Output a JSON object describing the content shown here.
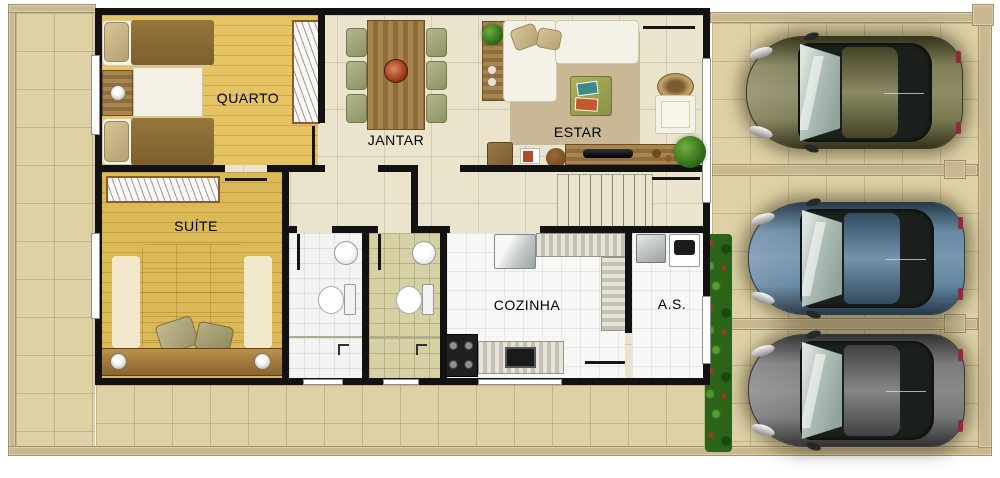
{
  "plan_labels": {
    "quarto": "QUARTO",
    "jantar": "JANTAR",
    "estar": "ESTAR",
    "suite": "SUÍTE",
    "cozinha": "COZINHA",
    "servico": "A.S."
  },
  "colors": {
    "outer_wall": "#c9b890",
    "house_wall": "#121212",
    "ground_tile": "#ddd1a5",
    "wood_floor": "#e6c463",
    "cream_floor": "#e9e4cb",
    "bath_olive_floor": "#d6d0a5",
    "hedge_green": "#2c641a",
    "sofa_white": "#f4f1e6",
    "dining_wood": "#a8854e"
  },
  "garage": {
    "cars": [
      {
        "name": "car-olive",
        "color": "#6a6839"
      },
      {
        "name": "car-blue",
        "color": "#4e7594"
      },
      {
        "name": "car-gray",
        "color": "#646466"
      }
    ]
  }
}
